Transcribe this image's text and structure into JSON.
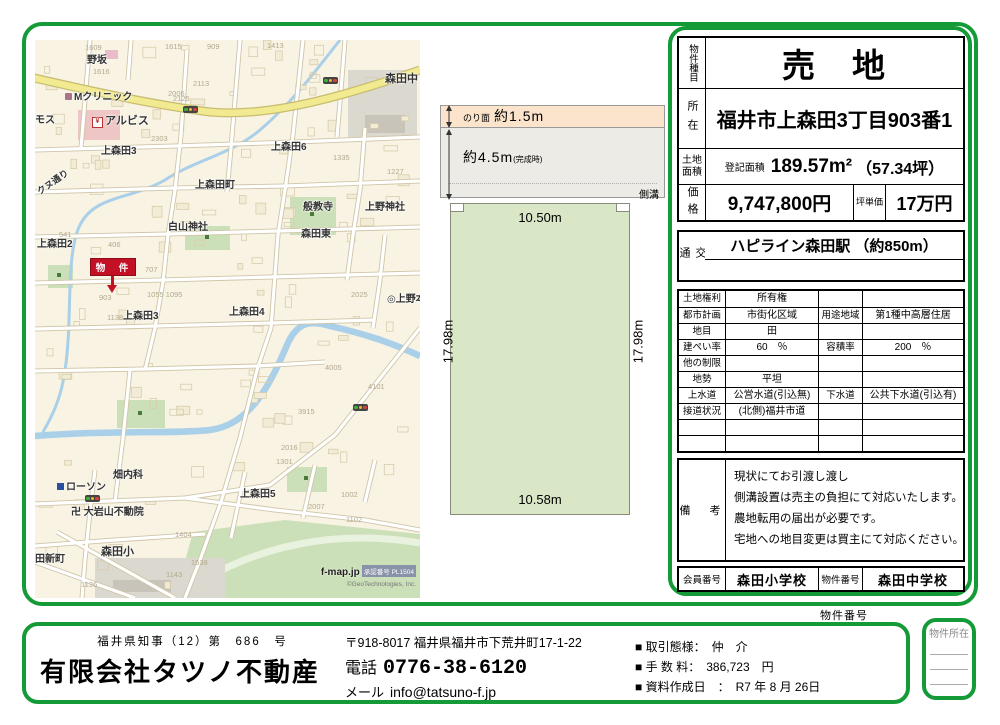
{
  "map": {
    "attribution": {
      "brand": "f-map.jp",
      "approval": "承認番号 PL1504",
      "copyright": "©GeoTechnologies, Inc."
    },
    "marker": {
      "label": "物　件"
    },
    "labels": [
      {
        "t": "野坂",
        "x": 52,
        "y": 16,
        "s": 10
      },
      {
        "t": "Mクリニック",
        "x": 30,
        "y": 53,
        "s": 10,
        "i": "clinic"
      },
      {
        "t": "アルビス",
        "x": 57,
        "y": 76,
        "s": 11,
        "i": "yen"
      },
      {
        "t": "モス",
        "x": 0,
        "y": 76,
        "s": 10
      },
      {
        "t": "上森田3",
        "x": 66,
        "y": 107,
        "s": 10
      },
      {
        "t": "森田中",
        "x": 350,
        "y": 34,
        "s": 11
      },
      {
        "t": "上森田6",
        "x": 236,
        "y": 103,
        "s": 10
      },
      {
        "t": "上森田町",
        "x": 160,
        "y": 141,
        "s": 10
      },
      {
        "t": "白山神社",
        "x": 133,
        "y": 183,
        "s": 10
      },
      {
        "t": "上森田2",
        "x": 2,
        "y": 200,
        "s": 10
      },
      {
        "t": "般教寺",
        "x": 268,
        "y": 163,
        "s": 10
      },
      {
        "t": "上野神社",
        "x": 330,
        "y": 163,
        "s": 10
      },
      {
        "t": "森田東",
        "x": 266,
        "y": 190,
        "s": 10
      },
      {
        "t": "上森田3",
        "x": 88,
        "y": 272,
        "s": 10
      },
      {
        "t": "上森田4",
        "x": 194,
        "y": 268,
        "s": 10
      },
      {
        "t": "◎上野本",
        "x": 352,
        "y": 255,
        "s": 10
      },
      {
        "t": "畑内科",
        "x": 78,
        "y": 431,
        "s": 10
      },
      {
        "t": "ローソン",
        "x": 22,
        "y": 443,
        "s": 10,
        "i": "conv"
      },
      {
        "t": "卍 大岩山不動院",
        "x": 36,
        "y": 468,
        "s": 10
      },
      {
        "t": "森田小",
        "x": 66,
        "y": 507,
        "s": 11
      },
      {
        "t": "上森田5",
        "x": 205,
        "y": 450,
        "s": 10
      },
      {
        "t": "田新町",
        "x": 0,
        "y": 515,
        "s": 10
      },
      {
        "t": "クヌ通り",
        "x": 0,
        "y": 138,
        "s": 9,
        "r": -35
      }
    ],
    "parcels": [
      {
        "n": "1609",
        "x": 50,
        "y": 4
      },
      {
        "n": "1616",
        "x": 58,
        "y": 28
      },
      {
        "n": "1615",
        "x": 130,
        "y": 3
      },
      {
        "n": "2006",
        "x": 133,
        "y": 50
      },
      {
        "n": "2113",
        "x": 158,
        "y": 40
      },
      {
        "n": "2125",
        "x": 138,
        "y": 55
      },
      {
        "n": "1413",
        "x": 232,
        "y": 2
      },
      {
        "n": "909",
        "x": 172,
        "y": 3
      },
      {
        "n": "2303",
        "x": 116,
        "y": 95
      },
      {
        "n": "1335",
        "x": 298,
        "y": 114
      },
      {
        "n": "1227",
        "x": 352,
        "y": 128
      },
      {
        "n": "541",
        "x": 24,
        "y": 191
      },
      {
        "n": "406",
        "x": 73,
        "y": 201
      },
      {
        "n": "707",
        "x": 110,
        "y": 226
      },
      {
        "n": "1055 1095",
        "x": 112,
        "y": 251
      },
      {
        "n": "903",
        "x": 64,
        "y": 254
      },
      {
        "n": "1138",
        "x": 72,
        "y": 274
      },
      {
        "n": "2025",
        "x": 316,
        "y": 251
      },
      {
        "n": "4005",
        "x": 290,
        "y": 324
      },
      {
        "n": "4101",
        "x": 333,
        "y": 343
      },
      {
        "n": "3915",
        "x": 263,
        "y": 368
      },
      {
        "n": "2016",
        "x": 246,
        "y": 404
      },
      {
        "n": "1301",
        "x": 241,
        "y": 418
      },
      {
        "n": "1002",
        "x": 306,
        "y": 451
      },
      {
        "n": "2007",
        "x": 273,
        "y": 463
      },
      {
        "n": "1102",
        "x": 311,
        "y": 476
      },
      {
        "n": "1404",
        "x": 140,
        "y": 491
      },
      {
        "n": "1538",
        "x": 156,
        "y": 519
      },
      {
        "n": "1143",
        "x": 131,
        "y": 531
      },
      {
        "n": "1136",
        "x": 46,
        "y": 541
      }
    ],
    "lights": [
      {
        "x": 148,
        "y": 66
      },
      {
        "x": 288,
        "y": 37
      },
      {
        "x": 50,
        "y": 455
      },
      {
        "x": 318,
        "y": 364
      }
    ]
  },
  "plot": {
    "slope_label": "のり面",
    "slope_value": "約1.5m",
    "depth_value": "約4.5m",
    "depth_note": "(完成時)",
    "ditch_label": "側溝",
    "top_width": "10.50m",
    "bottom_width": "10.58m",
    "side_left": "17.98m",
    "side_right": "17.98m"
  },
  "panel": {
    "type_label": "物件種目",
    "type_value": "売　地",
    "loc_label": "所在",
    "loc_value": "福井市上森田3丁目903番1",
    "area_label": "土地面積",
    "area_prefix": "登記面積",
    "area_value": "189.57m²",
    "area_tsubo": "（57.34坪）",
    "price_label": "価格",
    "price_value": "9,747,800円",
    "unit_label": "坪単価",
    "unit_value": "17万円",
    "transport_label": "交通",
    "transport_value": "ハピライン森田駅 （約850m）",
    "details_rows": [
      [
        "土地権利",
        "所有権",
        "",
        ""
      ],
      [
        "都市計画",
        "市街化区域",
        "用途地域",
        "第1種中高層住居"
      ],
      [
        "地目",
        "田",
        "",
        ""
      ],
      [
        "建ぺい率",
        "60　％",
        "容積率",
        "200　％"
      ],
      [
        "他の制限",
        "",
        "",
        ""
      ],
      [
        "地勢",
        "平坦",
        "",
        ""
      ],
      [
        "上水道",
        "公営水道(引込無)",
        "下水道",
        "公共下水道(引込有)"
      ],
      [
        "接道状況",
        "(北側)福井市道",
        "",
        ""
      ],
      [
        "",
        "",
        "",
        ""
      ],
      [
        "",
        "",
        "",
        ""
      ]
    ],
    "remarks_label": "備　考",
    "remarks_lines": [
      "現状にてお引渡し渡し",
      "側溝設置は売主の負担にて対応いたします。",
      "農地転用の届出が必要です。",
      "宅地への地目変更は買主にて対応ください。"
    ],
    "member_label": "会員番号",
    "member_value": "森田小学校",
    "propno_label": "物件番号",
    "propno_value": "森田中学校"
  },
  "footer": {
    "prop_no_label": "物件番号",
    "license": "福井県知事（12）第　686　号",
    "company": "有限会社タツノ不動産",
    "address": "〒918-8017 福井県福井市下荒井町17-1-22",
    "tel_label": "電話",
    "tel": "0776-38-6120",
    "mail_label": "メール",
    "mail": "info@tatsuno-f.jp",
    "items": [
      "■ 取引態様：　仲　介",
      "■ 手 数 料：　386,723　円",
      "■ 資料作成日　：　R7 年 8 月 26日"
    ],
    "side_box_label": "物件所在"
  }
}
